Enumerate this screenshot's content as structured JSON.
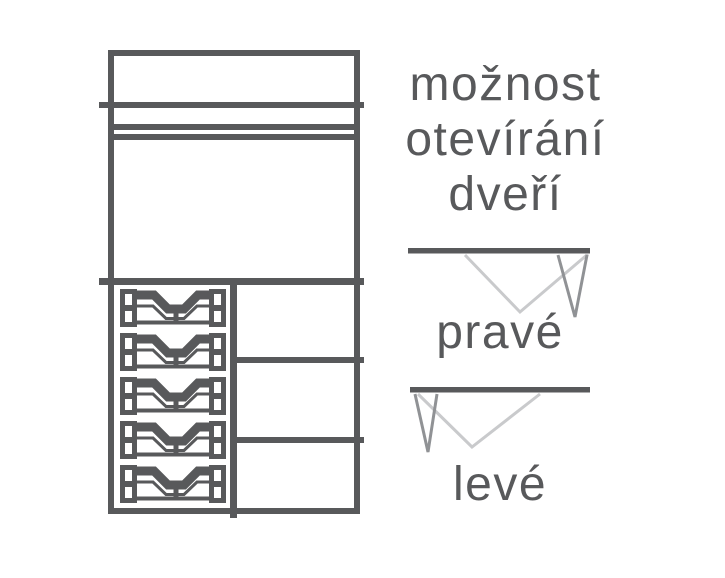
{
  "colors": {
    "dark": "#58595b",
    "mid": "#909295",
    "light": "#c9cacc",
    "text": "#58595b",
    "background": "#ffffff"
  },
  "heading": {
    "lines": [
      "možnost",
      "otevírání",
      "dveří"
    ]
  },
  "options": [
    {
      "label": "pravé",
      "icon": "door-swing-right-icon"
    },
    {
      "label": "levé",
      "icon": "door-swing-left-icon"
    }
  ],
  "furniture": {
    "icon": "wardrobe-front-diagram",
    "drawer_basket_count": 5,
    "right_shelf_compartments": 3
  }
}
